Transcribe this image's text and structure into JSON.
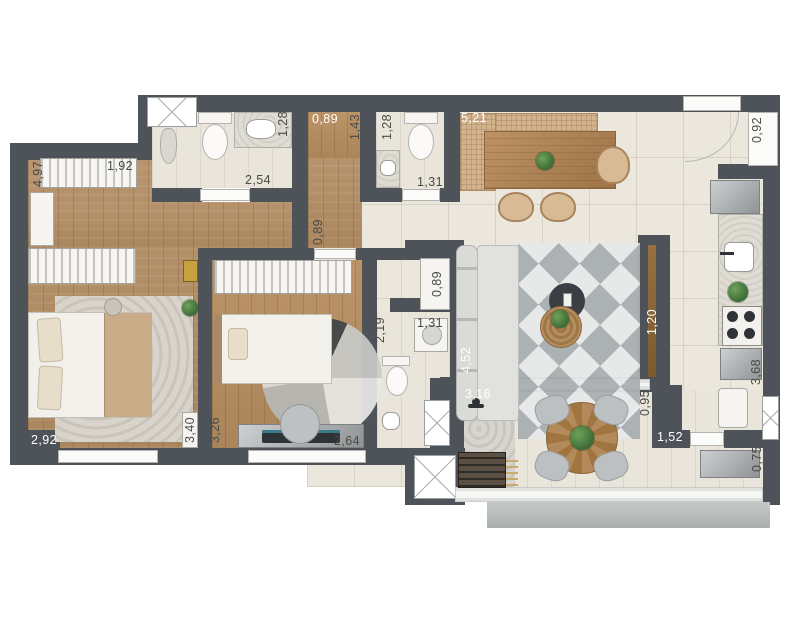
{
  "image_type": "apartment-floor-plan",
  "colors": {
    "wall": "#4e535a",
    "wood_floor": "#b2906a",
    "tile_floor": "#ebe7dd",
    "balcony_ledge": "#b6bab9",
    "rug_accent_dark": "#3f4347",
    "label_dark": "#4b4b46",
    "label_light": "#ffffff"
  },
  "dimension_labels": [
    {
      "id": "suite-length",
      "text": "4,97",
      "orientation": "vertical",
      "color": "dark",
      "cx": 38,
      "cy": 174
    },
    {
      "id": "suite-closet-width",
      "text": "1,92",
      "orientation": "horizontal",
      "color": "dark",
      "cx": 120,
      "cy": 166
    },
    {
      "id": "suite-bath-width",
      "text": "1,28",
      "orientation": "vertical",
      "color": "dark",
      "cx": 283,
      "cy": 124
    },
    {
      "id": "suite-bath-length",
      "text": "2,54",
      "orientation": "horizontal",
      "color": "dark",
      "cx": 258,
      "cy": 180
    },
    {
      "id": "top-niche-width",
      "text": "0,89",
      "orientation": "horizontal",
      "color": "light",
      "cx": 325,
      "cy": 119
    },
    {
      "id": "top-niche-depth",
      "text": "1,43",
      "orientation": "vertical",
      "color": "dark",
      "cx": 355,
      "cy": 127
    },
    {
      "id": "lavabo-width",
      "text": "1,28",
      "orientation": "vertical",
      "color": "dark",
      "cx": 387,
      "cy": 127
    },
    {
      "id": "lavabo-length",
      "text": "1,31",
      "orientation": "horizontal",
      "color": "dark",
      "cx": 430,
      "cy": 182
    },
    {
      "id": "dining-length",
      "text": "5,21",
      "orientation": "horizontal",
      "color": "light",
      "cx": 474,
      "cy": 118
    },
    {
      "id": "right-window",
      "text": "0,92",
      "orientation": "vertical",
      "color": "dark",
      "cx": 757,
      "cy": 130
    },
    {
      "id": "hall-width",
      "text": "0,89",
      "orientation": "vertical",
      "color": "dark",
      "cx": 318,
      "cy": 232
    },
    {
      "id": "laundry-niche",
      "text": "0,89",
      "orientation": "vertical",
      "color": "dark",
      "cx": 437,
      "cy": 284
    },
    {
      "id": "bath2-width",
      "text": "1,31",
      "orientation": "horizontal",
      "color": "dark",
      "cx": 430,
      "cy": 323
    },
    {
      "id": "bath2-length",
      "text": "2,19",
      "orientation": "vertical",
      "color": "dark",
      "cx": 380,
      "cy": 330
    },
    {
      "id": "living-length",
      "text": "4,52",
      "orientation": "vertical",
      "color": "light",
      "cx": 466,
      "cy": 360
    },
    {
      "id": "island-length",
      "text": "1,20",
      "orientation": "vertical",
      "color": "light",
      "cx": 652,
      "cy": 322
    },
    {
      "id": "kitchen-passage",
      "text": "0,95",
      "orientation": "vertical",
      "color": "dark",
      "cx": 645,
      "cy": 403
    },
    {
      "id": "kitchen-opening",
      "text": "1,52",
      "orientation": "horizontal",
      "color": "light",
      "cx": 670,
      "cy": 437
    },
    {
      "id": "kitchen-length",
      "text": "3,68",
      "orientation": "vertical",
      "color": "dark",
      "cx": 756,
      "cy": 372
    },
    {
      "id": "balcony-depth",
      "text": "0,75",
      "orientation": "vertical",
      "color": "dark",
      "cx": 757,
      "cy": 459
    },
    {
      "id": "balcony-left-width",
      "text": "3,16",
      "orientation": "horizontal",
      "color": "light",
      "cx": 478,
      "cy": 394
    },
    {
      "id": "suite-width",
      "text": "2,92",
      "orientation": "horizontal",
      "color": "light",
      "cx": 44,
      "cy": 440
    },
    {
      "id": "suite-inner-length",
      "text": "3,40",
      "orientation": "vertical",
      "color": "dark",
      "cx": 190,
      "cy": 430
    },
    {
      "id": "bed2-length",
      "text": "3,26",
      "orientation": "vertical",
      "color": "dark",
      "cx": 215,
      "cy": 430
    },
    {
      "id": "bed2-width",
      "text": "2,64",
      "orientation": "horizontal",
      "color": "dark",
      "cx": 347,
      "cy": 441
    }
  ]
}
